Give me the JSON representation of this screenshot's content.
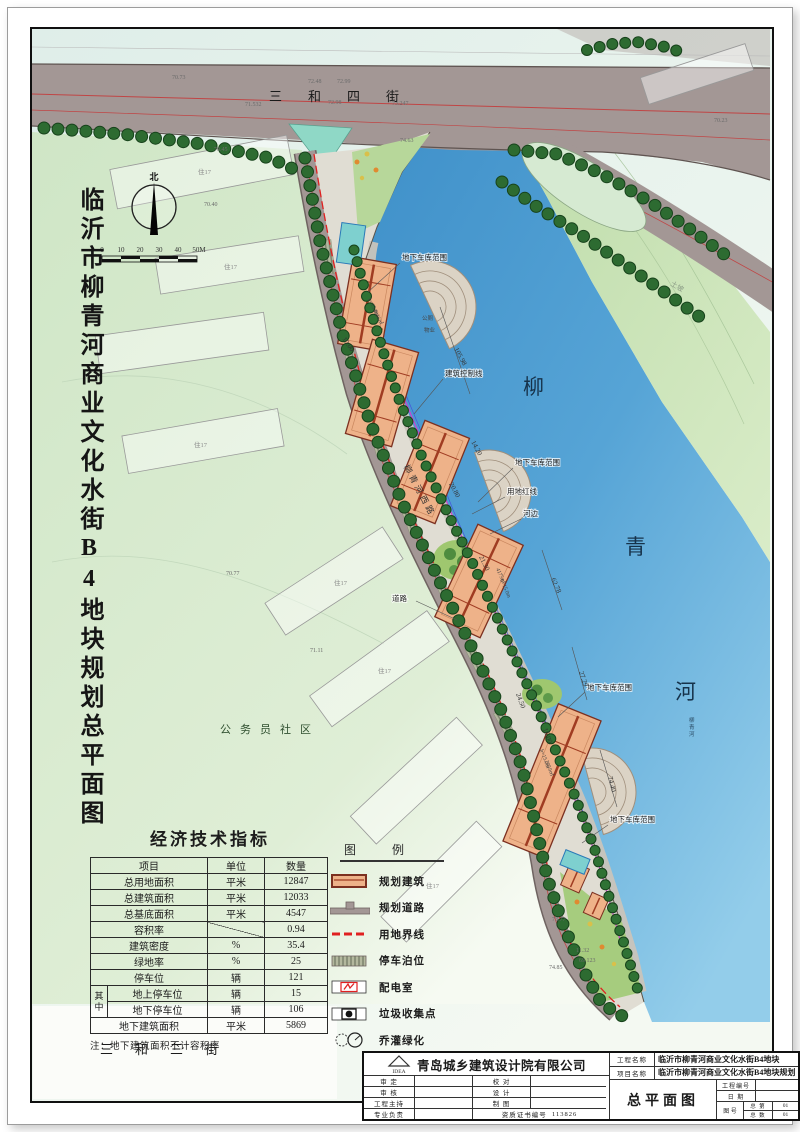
{
  "sheet": {
    "title_vertical": "临沂市柳青河商业文化水街B4地块规划总平面图"
  },
  "map": {
    "streets": {
      "top": "三和四街",
      "bottom": "三和三街",
      "west": "柳青河西路"
    },
    "river_name": [
      "柳",
      "青",
      "河"
    ],
    "north": "北",
    "scale_ticks": [
      "0",
      "10",
      "20",
      "30",
      "40",
      "50M"
    ],
    "community": "公务员社区",
    "slope_label": "土坡",
    "labels": {
      "garage": "地下车库范围",
      "control_line": "建筑控制线",
      "red_line": "用地红线",
      "river_edge": "河边",
      "road": "道路",
      "toilet": "公厕",
      "property": "物业",
      "resident": "住17"
    },
    "dims": {
      "d1": "105.98",
      "d2": "62.78",
      "d3": "27.29",
      "d4": "74.40",
      "d5": "20.80",
      "d6": "21.30",
      "d7": "16.00",
      "d8": "10.00",
      "d9": "14.20",
      "d10": "24.50"
    },
    "buildings": {
      "height": "h=15.0m",
      "area1": "4836㎡",
      "area2": "4175㎡",
      "area3": "2959㎡"
    },
    "elevations": {
      "e1": "74.63",
      "e2": "70.23",
      "e3": "70.45",
      "e4": "70.40",
      "e5": "70.77",
      "e6": "71.11",
      "e7": "73.77",
      "e8": "74.85",
      "e9": "72.48",
      "e10": "72.99",
      "e11": "71.532",
      "e12": "73.247",
      "e13": "72.98",
      "e14": "70.73",
      "e15": "11.32",
      "e16": "69.123"
    }
  },
  "indicators": {
    "title": "经济技术指标",
    "headers": [
      "项目",
      "单位",
      "数量"
    ],
    "rows": [
      {
        "item": "总用地面积",
        "unit": "平米",
        "value": "12847"
      },
      {
        "item": "总建筑面积",
        "unit": "平米",
        "value": "12033"
      },
      {
        "item": "总基底面积",
        "unit": "平米",
        "value": "4547"
      },
      {
        "item": "容积率",
        "unit": "",
        "value": "0.94"
      },
      {
        "item": "建筑密度",
        "unit": "%",
        "value": "35.4"
      },
      {
        "item": "绿地率",
        "unit": "%",
        "value": "25"
      },
      {
        "item": "停车位",
        "unit": "辆",
        "value": "121"
      },
      {
        "item": "地上停车位",
        "unit": "辆",
        "value": "15"
      },
      {
        "item": "地下停车位",
        "unit": "辆",
        "value": "106"
      },
      {
        "item": "地下建筑面积",
        "unit": "平米",
        "value": "5869"
      }
    ],
    "group_label": "其中",
    "note": "注：地下建筑面积不计容积率"
  },
  "legend": {
    "title": "图例",
    "items": [
      {
        "label": "规划建筑"
      },
      {
        "label": "规划道路"
      },
      {
        "label": "用地界线"
      },
      {
        "label": "停车泊位"
      },
      {
        "label": "配电室"
      },
      {
        "label": "垃圾收集点"
      },
      {
        "label": "乔灌绿化"
      }
    ]
  },
  "titleblock": {
    "company": "青岛城乡建筑设计院有限公司",
    "logo_text": "IDEA",
    "sign": {
      "r1l": "审  定",
      "r1r": "校  对",
      "r2l": "审  核",
      "r2r": "设  计",
      "r3l": "工程主持",
      "r3r": "制  图",
      "r4l": "专业负责",
      "cert_label": "资质证书编号",
      "cert_value": "113826"
    },
    "project_label": "工程名称",
    "project_value": "临沂市柳青河商业文化水街B4地块",
    "item_label": "项目名称",
    "item_value": "临沂市柳青河商业文化水街B4地块规划",
    "drawing_name": "总平面图",
    "no_label": "工程编号",
    "date_label": "日  期",
    "fig_label": "图  号",
    "fig_r1_label": "总  第",
    "fig_r1_value": "01",
    "fig_r2_label": "总  数",
    "fig_r2_value": "01"
  }
}
